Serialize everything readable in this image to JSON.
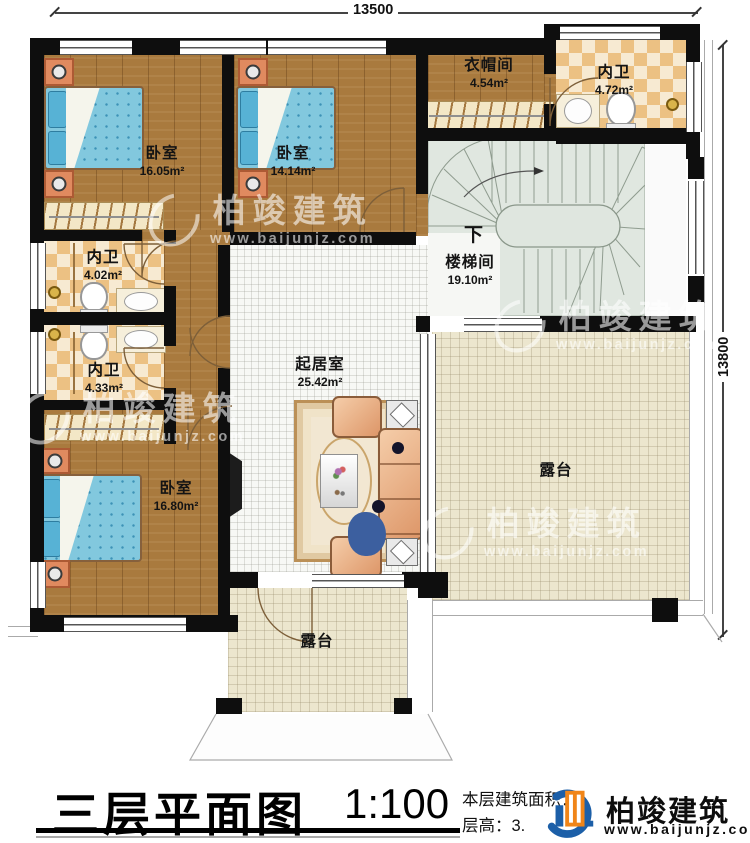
{
  "dimensions": {
    "top": "13500",
    "right": "13800"
  },
  "rooms": {
    "bedroom1": {
      "name": "卧室",
      "area": "16.05m²"
    },
    "bedroom2": {
      "name": "卧室",
      "area": "14.14m²"
    },
    "cloakroom": {
      "name": "衣帽间",
      "area": "4.54m²"
    },
    "bath_top": {
      "name": "内卫",
      "area": "4.72m²"
    },
    "stairwell": {
      "name": "楼梯间",
      "area": "19.10m²",
      "direction": "下"
    },
    "bath_mid1": {
      "name": "内卫",
      "area": "4.02m²"
    },
    "bath_mid2": {
      "name": "内卫",
      "area": "4.33m²"
    },
    "bedroom3": {
      "name": "卧室",
      "area": "16.80m²"
    },
    "living": {
      "name": "起居室",
      "area": "25.42m²"
    },
    "terrace_right": {
      "name": "露台"
    },
    "terrace_bottom": {
      "name": "露台"
    }
  },
  "title": {
    "text": "三层平面图",
    "scale": "1:100"
  },
  "info": {
    "line1": "本层建筑面积：",
    "line2": "层高：3."
  },
  "logo": {
    "name": "柏竣建筑",
    "url": "www.baijunjz.com"
  },
  "watermark": {
    "name": "柏竣建筑",
    "url": "www.baijunjz.com"
  },
  "colors": {
    "wall": "#0e0e0e",
    "wood": "#a97a3e",
    "tile": "#ecc183",
    "stair": "#dfe6df",
    "terrace": "#ece6ce",
    "bed": "#82c8de",
    "logo_blue": "#1c5fa8",
    "logo_orange": "#f08519"
  }
}
